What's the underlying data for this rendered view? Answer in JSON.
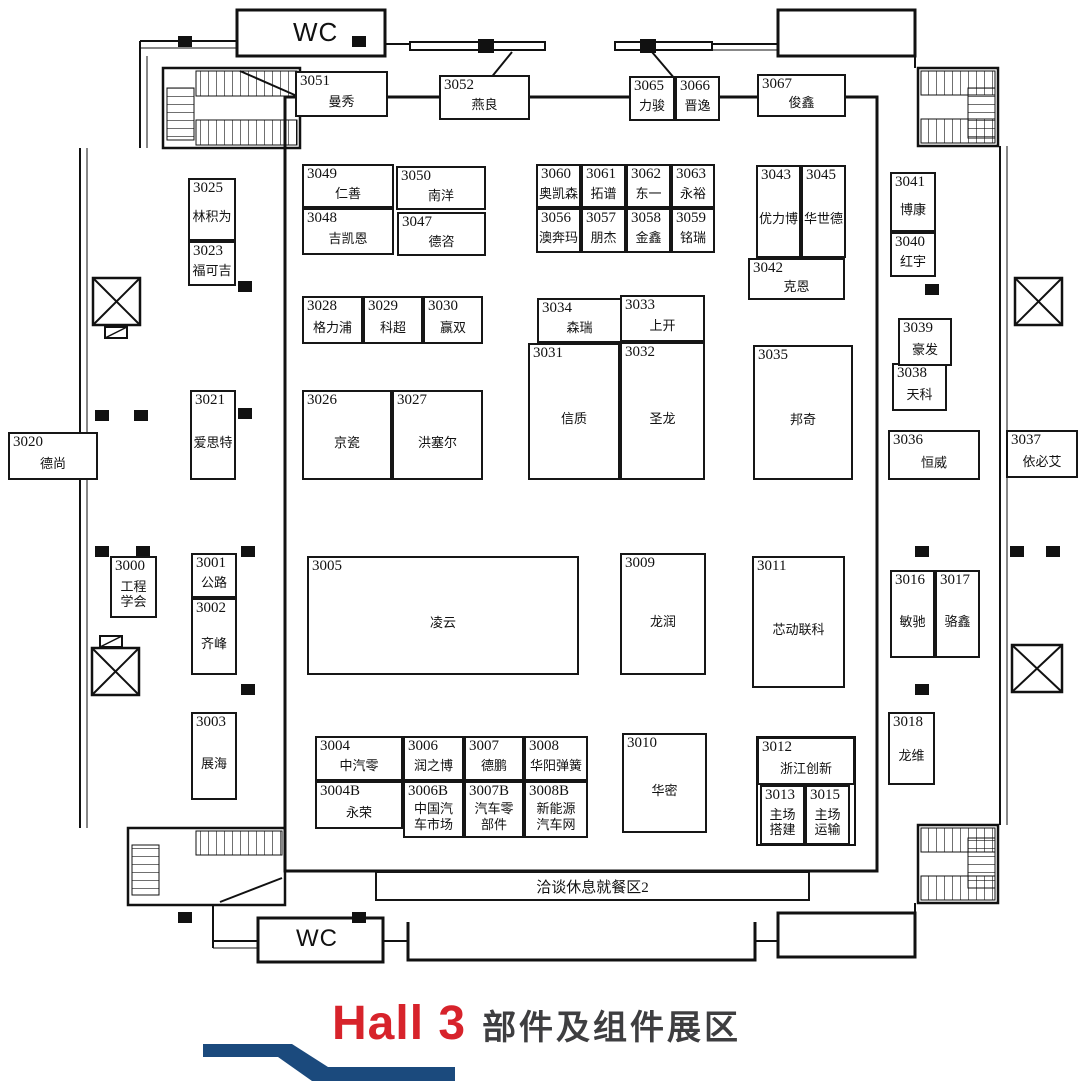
{
  "hall": {
    "title_en": "Hall 3",
    "title_zh": "部件及组件展区",
    "accent_red": "#d7232b",
    "ribbon_blue": "#1b4a7d"
  },
  "labels": {
    "wc_top": "WC",
    "wc_bottom": "WC",
    "dining_area": "洽谈休息就餐区2"
  },
  "floorplan": {
    "booths": [
      {
        "id": "3051",
        "name": "曼秀",
        "x": 295,
        "y": 71,
        "w": 93,
        "h": 46
      },
      {
        "id": "3052",
        "name": "燕良",
        "x": 439,
        "y": 75,
        "w": 91,
        "h": 45
      },
      {
        "id": "3065",
        "name": "力骏",
        "x": 629,
        "y": 76,
        "w": 46,
        "h": 45
      },
      {
        "id": "3066",
        "name": "晋逸",
        "x": 675,
        "y": 76,
        "w": 45,
        "h": 45
      },
      {
        "id": "3067",
        "name": "俊鑫",
        "x": 757,
        "y": 74,
        "w": 89,
        "h": 43
      },
      {
        "id": "3049",
        "name": "仁善",
        "x": 302,
        "y": 164,
        "w": 92,
        "h": 44
      },
      {
        "id": "3050",
        "name": "南洋",
        "x": 396,
        "y": 166,
        "w": 90,
        "h": 44
      },
      {
        "id": "3048",
        "name": "吉凯恩",
        "x": 302,
        "y": 208,
        "w": 92,
        "h": 47
      },
      {
        "id": "3047",
        "name": "德咨",
        "x": 397,
        "y": 212,
        "w": 89,
        "h": 44
      },
      {
        "id": "3060",
        "name": "奥凯森",
        "x": 536,
        "y": 164,
        "w": 45,
        "h": 44
      },
      {
        "id": "3061",
        "name": "拓谱",
        "x": 581,
        "y": 164,
        "w": 45,
        "h": 44
      },
      {
        "id": "3062",
        "name": "东一",
        "x": 626,
        "y": 164,
        "w": 45,
        "h": 44
      },
      {
        "id": "3063",
        "name": "永裕",
        "x": 671,
        "y": 164,
        "w": 44,
        "h": 44
      },
      {
        "id": "3056",
        "name": "澳奔玛",
        "x": 536,
        "y": 208,
        "w": 45,
        "h": 45
      },
      {
        "id": "3057",
        "name": "朋杰",
        "x": 581,
        "y": 208,
        "w": 45,
        "h": 45
      },
      {
        "id": "3058",
        "name": "金鑫",
        "x": 626,
        "y": 208,
        "w": 45,
        "h": 45
      },
      {
        "id": "3059",
        "name": "铭瑞",
        "x": 671,
        "y": 208,
        "w": 44,
        "h": 45
      },
      {
        "id": "3043",
        "name": "优力博",
        "x": 756,
        "y": 165,
        "w": 45,
        "h": 93
      },
      {
        "id": "3045",
        "name": "华世德",
        "x": 801,
        "y": 165,
        "w": 45,
        "h": 93
      },
      {
        "id": "3042",
        "name": "克恩",
        "x": 748,
        "y": 258,
        "w": 97,
        "h": 42
      },
      {
        "id": "3025",
        "name": "林积为",
        "x": 188,
        "y": 178,
        "w": 48,
        "h": 63
      },
      {
        "id": "3023",
        "name": "福可吉",
        "x": 188,
        "y": 241,
        "w": 48,
        "h": 45
      },
      {
        "id": "3021",
        "name": "爱思特",
        "x": 190,
        "y": 390,
        "w": 46,
        "h": 90
      },
      {
        "id": "3020",
        "name": "德尚",
        "x": 8,
        "y": 432,
        "w": 90,
        "h": 48
      },
      {
        "id": "3028",
        "name": "格力浦",
        "x": 302,
        "y": 296,
        "w": 61,
        "h": 48
      },
      {
        "id": "3029",
        "name": "科超",
        "x": 363,
        "y": 296,
        "w": 60,
        "h": 48
      },
      {
        "id": "3030",
        "name": "赢双",
        "x": 423,
        "y": 296,
        "w": 60,
        "h": 48
      },
      {
        "id": "3031",
        "name": "信质",
        "x": 528,
        "y": 343,
        "w": 92,
        "h": 137
      },
      {
        "id": "3032",
        "name": "圣龙",
        "x": 620,
        "y": 342,
        "w": 85,
        "h": 138
      },
      {
        "id": "3034",
        "name": "森瑞",
        "x": 537,
        "y": 298,
        "w": 85,
        "h": 45
      },
      {
        "id": "3033",
        "name": "上开",
        "x": 620,
        "y": 295,
        "w": 85,
        "h": 47
      },
      {
        "id": "3026",
        "name": "京瓷",
        "x": 302,
        "y": 390,
        "w": 90,
        "h": 90
      },
      {
        "id": "3027",
        "name": "洪塞尔",
        "x": 392,
        "y": 390,
        "w": 91,
        "h": 90
      },
      {
        "id": "3035",
        "name": "邦奇",
        "x": 753,
        "y": 345,
        "w": 100,
        "h": 135
      },
      {
        "id": "3041",
        "name": "博康",
        "x": 890,
        "y": 172,
        "w": 46,
        "h": 60
      },
      {
        "id": "3040",
        "name": "红宇",
        "x": 890,
        "y": 232,
        "w": 46,
        "h": 45
      },
      {
        "id": "3038",
        "name": "天科",
        "x": 892,
        "y": 363,
        "w": 55,
        "h": 48
      },
      {
        "id": "3039",
        "name": "豪发",
        "x": 898,
        "y": 318,
        "w": 54,
        "h": 48
      },
      {
        "id": "3036",
        "name": "恒威",
        "x": 888,
        "y": 430,
        "w": 92,
        "h": 50
      },
      {
        "id": "3037",
        "name": "依必艾",
        "x": 1006,
        "y": 430,
        "w": 72,
        "h": 48
      },
      {
        "id": "3000",
        "name": "工程\n学会",
        "x": 110,
        "y": 556,
        "w": 47,
        "h": 62
      },
      {
        "id": "3001",
        "name": "公路",
        "x": 191,
        "y": 553,
        "w": 46,
        "h": 45
      },
      {
        "id": "3002",
        "name": "齐峰",
        "x": 191,
        "y": 598,
        "w": 46,
        "h": 77
      },
      {
        "id": "3003",
        "name": "展海",
        "x": 191,
        "y": 712,
        "w": 46,
        "h": 88
      },
      {
        "id": "3005",
        "name": "凌云",
        "x": 307,
        "y": 556,
        "w": 272,
        "h": 119
      },
      {
        "id": "3009",
        "name": "龙润",
        "x": 620,
        "y": 553,
        "w": 86,
        "h": 122
      },
      {
        "id": "3011",
        "name": "芯动联科",
        "x": 752,
        "y": 556,
        "w": 93,
        "h": 132
      },
      {
        "id": "3016",
        "name": "敏驰",
        "x": 890,
        "y": 570,
        "w": 45,
        "h": 88
      },
      {
        "id": "3017",
        "name": "骆鑫",
        "x": 935,
        "y": 570,
        "w": 45,
        "h": 88
      },
      {
        "id": "3018",
        "name": "龙维",
        "x": 888,
        "y": 712,
        "w": 47,
        "h": 73
      },
      {
        "id": "3004",
        "name": "中汽零",
        "x": 315,
        "y": 736,
        "w": 88,
        "h": 45
      },
      {
        "id": "3006",
        "name": "润之博",
        "x": 403,
        "y": 736,
        "w": 61,
        "h": 45
      },
      {
        "id": "3007",
        "name": "德鹏",
        "x": 464,
        "y": 736,
        "w": 60,
        "h": 45
      },
      {
        "id": "3008",
        "name": "华阳弹簧",
        "x": 524,
        "y": 736,
        "w": 64,
        "h": 45
      },
      {
        "id": "3004B",
        "name": "永荣",
        "x": 315,
        "y": 781,
        "w": 88,
        "h": 48
      },
      {
        "id": "3006B",
        "name": "中国汽\n车市场",
        "x": 403,
        "y": 781,
        "w": 61,
        "h": 57
      },
      {
        "id": "3007B",
        "name": "汽车零\n部件",
        "x": 464,
        "y": 781,
        "w": 60,
        "h": 57
      },
      {
        "id": "3008B",
        "name": "新能源\n汽车网",
        "x": 524,
        "y": 781,
        "w": 64,
        "h": 57
      },
      {
        "id": "3010",
        "name": "华密",
        "x": 622,
        "y": 733,
        "w": 85,
        "h": 100
      },
      {
        "id": "3012",
        "name": "浙江创新",
        "x": 757,
        "y": 737,
        "w": 98,
        "h": 48
      },
      {
        "id": "3013",
        "name": "主场\n搭建",
        "x": 760,
        "y": 785,
        "w": 45,
        "h": 60
      },
      {
        "id": "3015",
        "name": "主场\n运输",
        "x": 805,
        "y": 785,
        "w": 45,
        "h": 60
      }
    ]
  }
}
